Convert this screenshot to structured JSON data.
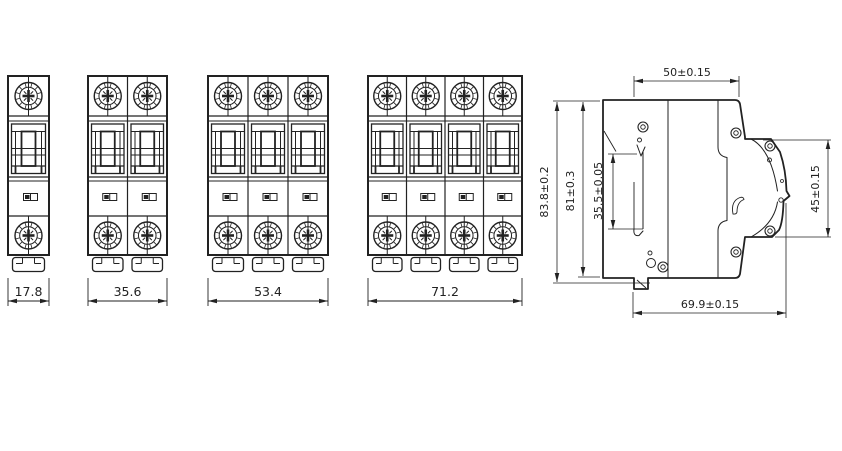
{
  "drawing": {
    "front_views": [
      {
        "poles": 1,
        "width_label": "17.8"
      },
      {
        "poles": 2,
        "width_label": "35.6"
      },
      {
        "poles": 3,
        "width_label": "53.4"
      },
      {
        "poles": 4,
        "width_label": "71.2"
      }
    ],
    "side_view": {
      "depth_top_label": "50±0.15",
      "height_overall_label": "83.8±0.2",
      "height_body_label": "81±0.3",
      "window_height_label": "35.5±0.05",
      "clip_height_label": "45±0.15",
      "depth_overall_label": "69.9±0.15"
    },
    "colors": {
      "line": "#222222",
      "background": "#ffffff"
    }
  }
}
